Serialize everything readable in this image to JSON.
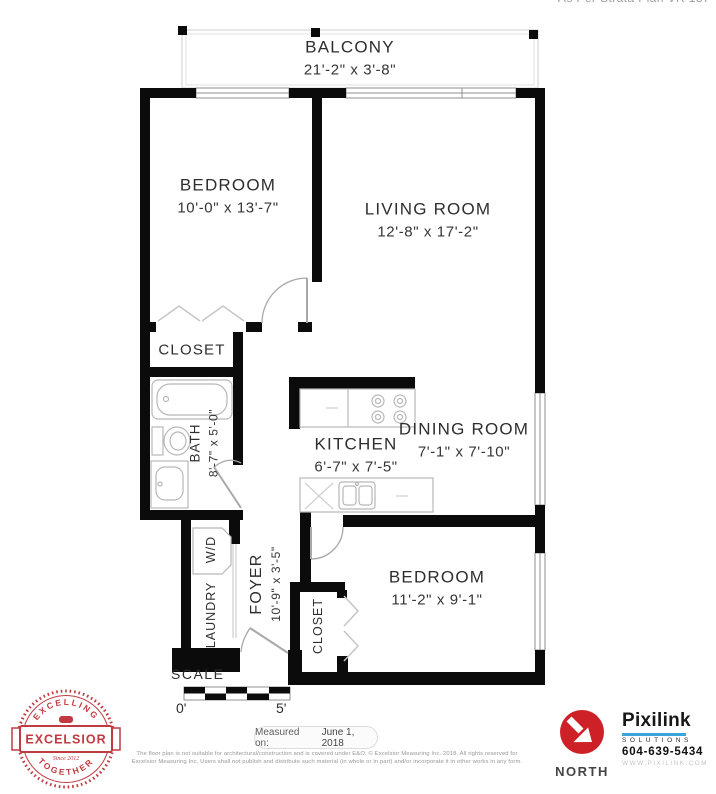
{
  "page": {
    "strata_note": "As Per Strata Plan VR 137"
  },
  "rooms": {
    "balcony": {
      "name": "BALCONY",
      "dims": "21'-2\" x 3'-8\""
    },
    "bedroom1": {
      "name": "BEDROOM",
      "dims": "10'-0\" x 13'-7\""
    },
    "living": {
      "name": "LIVING ROOM",
      "dims": "12'-8\" x 17'-2\""
    },
    "closet1": {
      "name": "CLOSET"
    },
    "bath": {
      "name": "BATH",
      "dims": "8'-7\" x 5'-0\""
    },
    "kitchen": {
      "name": "KITCHEN",
      "dims": "6'-7\" x 7'-5\""
    },
    "dining": {
      "name": "DINING ROOM",
      "dims": "7'-1\" x 7'-10\""
    },
    "laundry": {
      "name": "LAUNDRY",
      "appliance": "W/D"
    },
    "foyer": {
      "name": "FOYER",
      "dims": "10'-9\" x 3'-5\""
    },
    "bedroom2": {
      "name": "BEDROOM",
      "dims": "11'-2\" x 9'-1\""
    },
    "closet2": {
      "name": "CLOSET"
    }
  },
  "scale": {
    "label": "SCALE",
    "zero": "0'",
    "five": "5'"
  },
  "measured": {
    "label": "Measured on:",
    "date": "June 1, 2018"
  },
  "disclaimer": {
    "line1": "The floor plan is not suitable for architectural/construction and is covered under E&O. © Excelsior Measuring Inc. 2018. All rights reserved for",
    "line2": "Excelsior Measuring Inc. Users shall not publish and distribute such material (in whole or in part) and/or incorporate it in other works in any form."
  },
  "badge": {
    "arc_top": "EXCELLING",
    "arc_bottom": "TOGETHER",
    "banner": "EXCELSIOR",
    "since": "Since 2012"
  },
  "compass": {
    "label": "NORTH"
  },
  "vendor": {
    "brand": "Pixilink",
    "tagline": "SOLUTIONS",
    "phone": "604-639-5434",
    "website": "WWW.PIXILINK.COM"
  },
  "colors": {
    "wall": "#0b0b0b",
    "window_line": "#8f8f8f",
    "fixture_line": "#b7b7b7",
    "door_line": "#a8a8a8",
    "balcony_line": "#cccccc",
    "badge_red": "#c23a41",
    "north_red": "#ce2127",
    "vendor_blue": "#3aa3d9",
    "label_text": "#2e2e2e",
    "muted_text": "#979797"
  }
}
